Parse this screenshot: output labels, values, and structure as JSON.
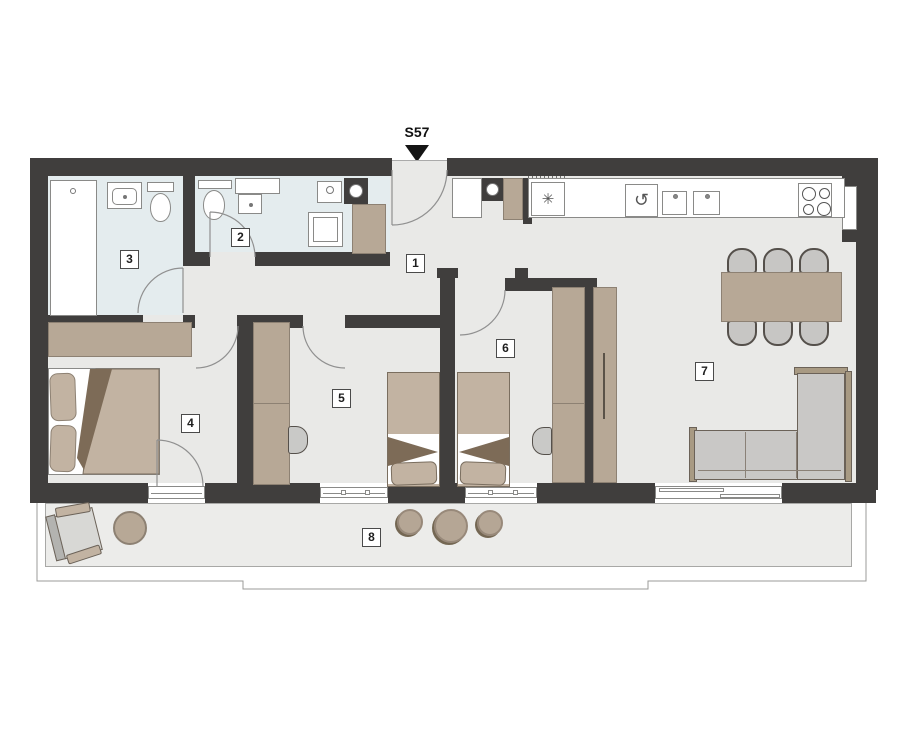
{
  "plan": {
    "unit_label": "S57",
    "rooms": [
      {
        "number": "1"
      },
      {
        "number": "2"
      },
      {
        "number": "3"
      },
      {
        "number": "4"
      },
      {
        "number": "5"
      },
      {
        "number": "6"
      },
      {
        "number": "7"
      },
      {
        "number": "8"
      }
    ]
  },
  "icons": {
    "fridge_glyph": "✳",
    "oven_glyph": "↺"
  },
  "colors": {
    "wall": "#403e3d",
    "floor": "#e9e9e7",
    "bath": "#e4ecee",
    "terr": "#ececea",
    "tan": "#b7a896",
    "tan_edge": "#8d8173",
    "bedtan": "#c2b3a2",
    "fold": "#7d6b57",
    "grey": "#d8d8d5",
    "outline": "#6b6258",
    "line": "#909090",
    "ink": "#1e1e1e"
  }
}
